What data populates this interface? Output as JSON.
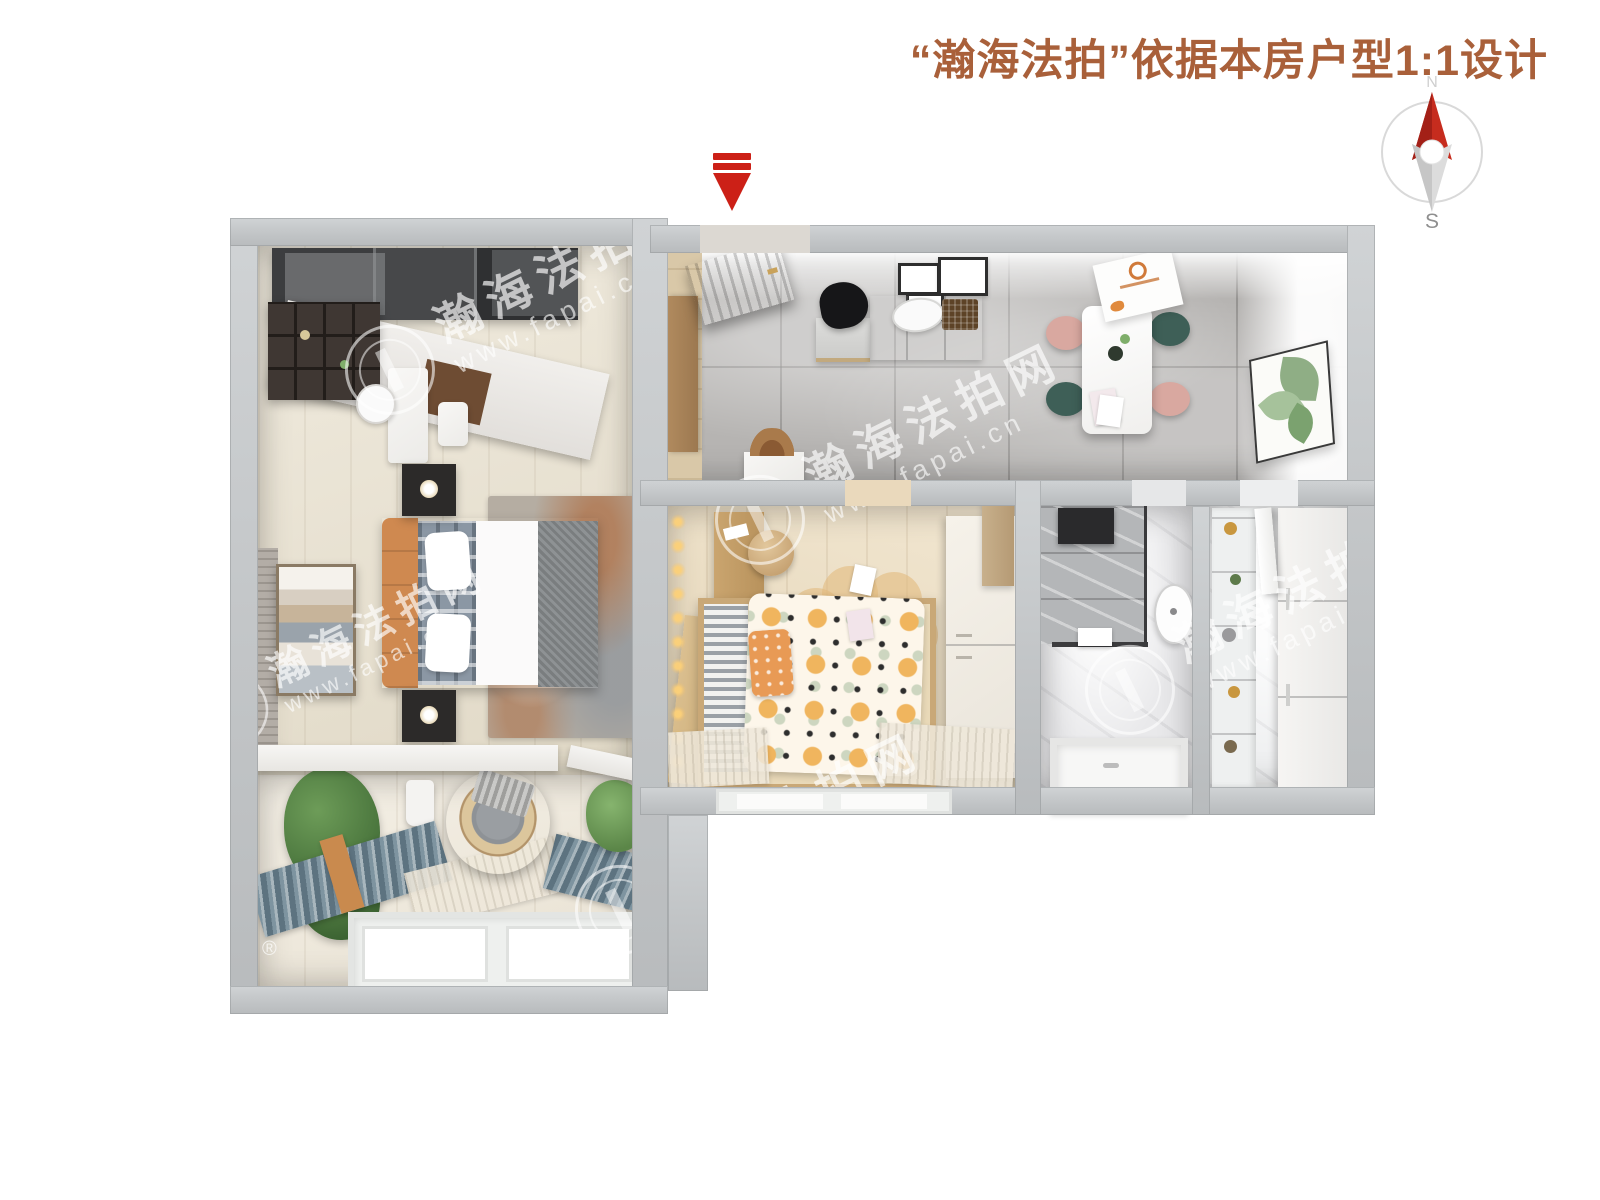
{
  "header": {
    "title": "“瀚海法拍”依据本房户型1:1设计",
    "title_color": "#a9603a"
  },
  "compass": {
    "north_label": "N",
    "south_label": "S",
    "needle_north_color": "#c02a1e",
    "needle_south_color": "#d8d8d8"
  },
  "entrance": {
    "direction": "down",
    "arrow_color": "#cc2017"
  },
  "watermark": {
    "brand": "瀚海法拍网",
    "url": "www.fapai.cn",
    "registered_mark": "®"
  },
  "palette": {
    "wall_gray": "#c2c5c7",
    "floor_wood_light": "#e8e0cd",
    "floor_wood_warm": "#ecdcbd",
    "floor_tile_gray": "#b6b4b2",
    "floor_marble_white": "#e9e9eb",
    "accent_orange_headboard": "#cf8950",
    "accent_orange_duvet_dots": "#f0b55e",
    "accent_blue_curtain": "#5d7380",
    "dining_chair_pink": "#d9a8a0",
    "dining_chair_green": "#3e5f57",
    "entry_door_dark": "#55585a"
  }
}
